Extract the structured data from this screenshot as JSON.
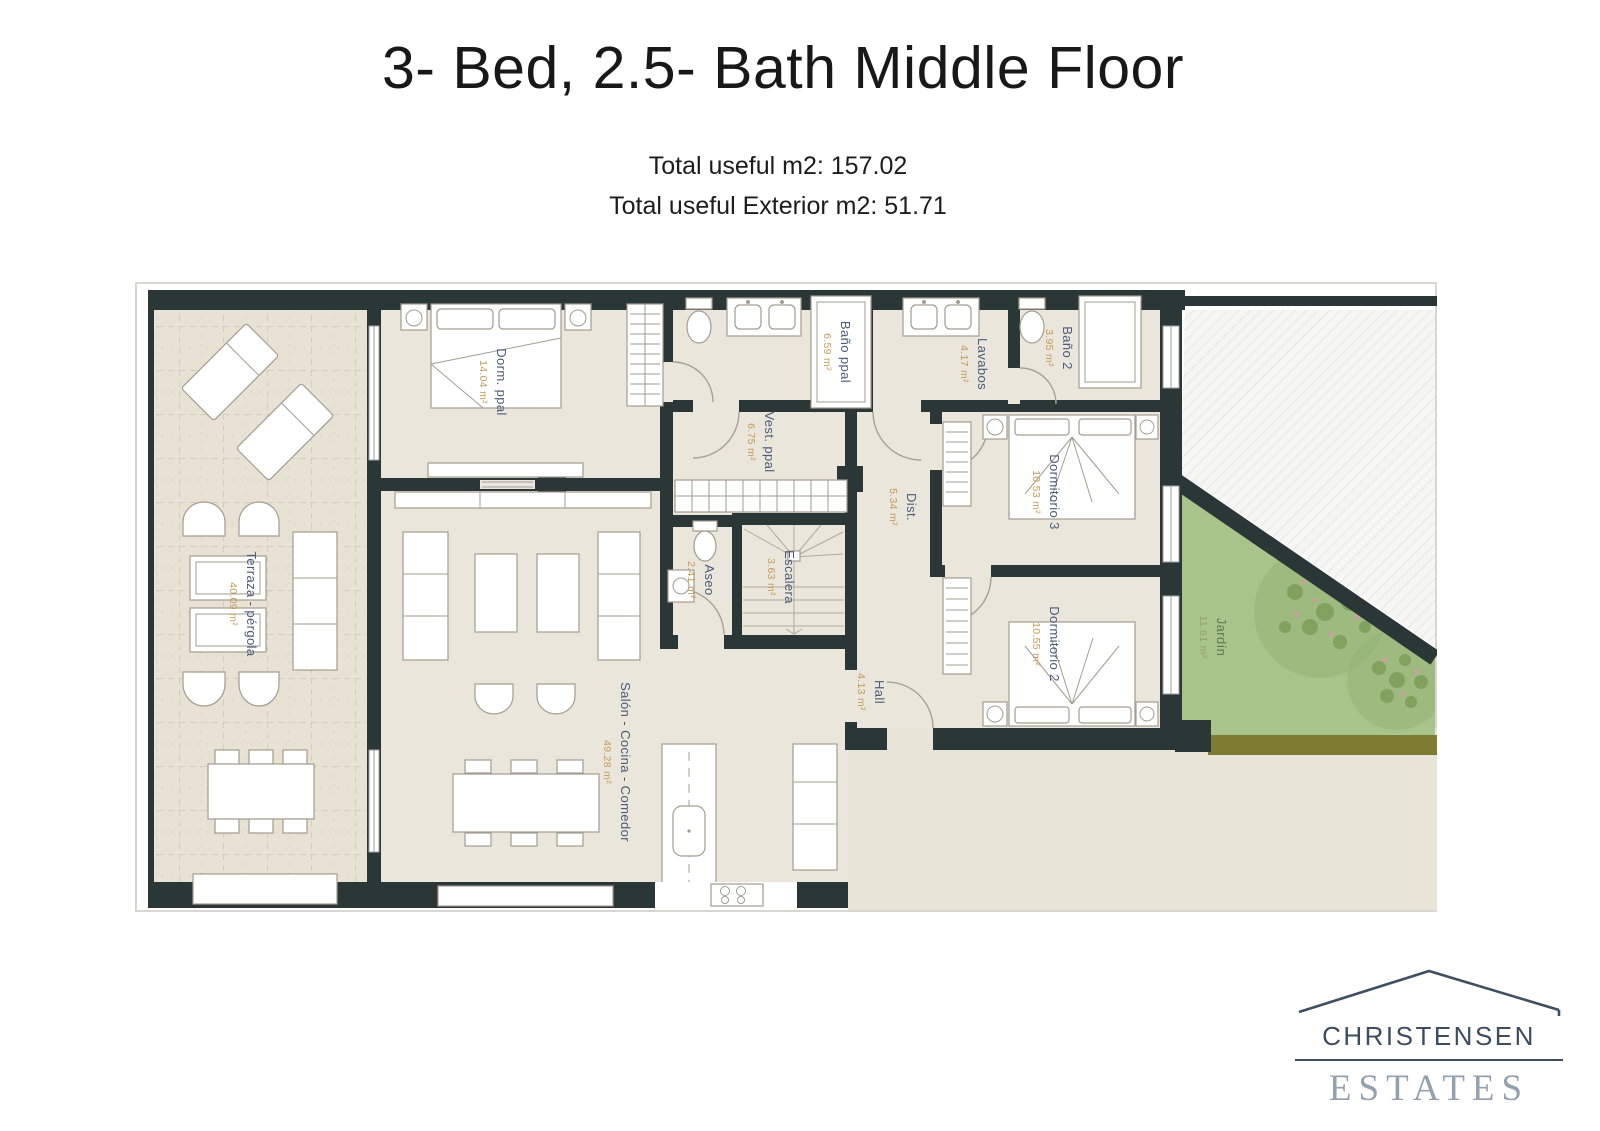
{
  "header": {
    "title": "3- Bed, 2.5- Bath Middle Floor",
    "subtitle_line1": "Total useful m2: 157.02",
    "subtitle_line2": "Total useful Exterior m2: 51.71"
  },
  "plan": {
    "rooms": [
      {
        "name": "Terraza - pérgola",
        "area": "40.09 m²"
      },
      {
        "name": "Dorm. ppal",
        "area": "14.04 m²"
      },
      {
        "name": "Baño ppal",
        "area": "6.59 m²"
      },
      {
        "name": "Vest. ppal",
        "area": "6.75 m²"
      },
      {
        "name": "Lavabos",
        "area": "4.17 m²"
      },
      {
        "name": "Baño 2",
        "area": "3.95 m²"
      },
      {
        "name": "Dormitorio 3",
        "area": "10.53 m²"
      },
      {
        "name": "Dist.",
        "area": "5.34 m²"
      },
      {
        "name": "Escalera",
        "area": "3.63 m²"
      },
      {
        "name": "Aseo",
        "area": "2.41 m²"
      },
      {
        "name": "Hall",
        "area": "4.13 m²"
      },
      {
        "name": "Dormitorio 2",
        "area": "10.55 m²"
      },
      {
        "name": "Salón - Cocina - Comedor",
        "area": "49.28 m²"
      },
      {
        "name": "Jardín",
        "area": "11.61 m²"
      }
    ],
    "colors": {
      "wall": "#2b3737",
      "interior_floor": "#eae6db",
      "terrace_floor": "#e7e2d4",
      "garden": "#a9c48b",
      "garden_soil_strip": "#7f7b33",
      "room_label": "#4c5b7a",
      "area_label": "#c49a58",
      "garden_label": "#5d7a4b"
    }
  },
  "logo": {
    "name": "CHRISTENSEN",
    "type": "ESTATES"
  }
}
